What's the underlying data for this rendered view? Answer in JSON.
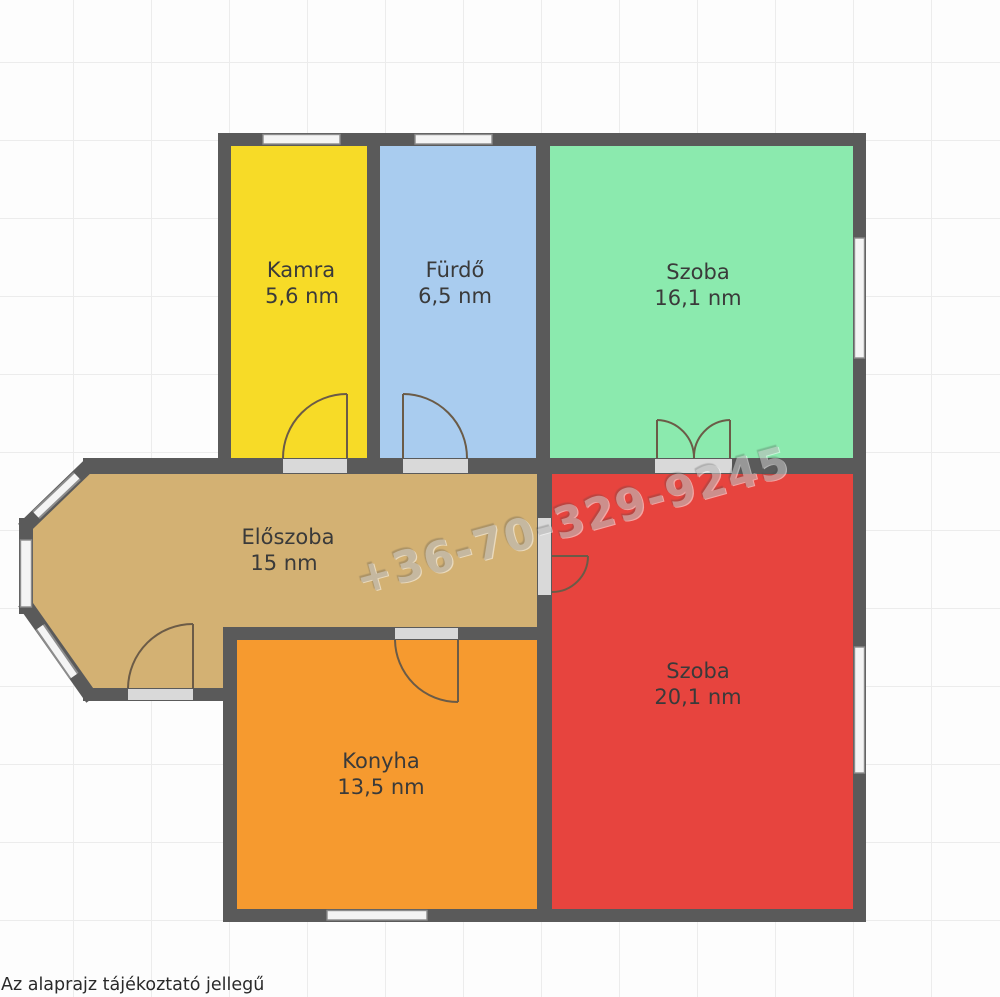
{
  "plan": {
    "rooms": [
      {
        "id": "kamra",
        "name": "Kamra",
        "area": "5,6 nm",
        "color": "#F7DB27"
      },
      {
        "id": "furdo",
        "name": "Fürdő",
        "area": "6,5 nm",
        "color": "#A9CCEF"
      },
      {
        "id": "szoba-1",
        "name": "Szoba",
        "area": "16,1 nm",
        "color": "#8BEAAE"
      },
      {
        "id": "eloszoba",
        "name": "Előszoba",
        "area": "15 nm",
        "color": "#D3B173"
      },
      {
        "id": "szoba-2",
        "name": "Szoba",
        "area": "20,1 nm",
        "color": "#E7443E"
      },
      {
        "id": "konyha",
        "name": "Konyha",
        "area": "13,5 nm",
        "color": "#F69A2F"
      }
    ]
  },
  "watermark": {
    "text": "+36-70-329-9245"
  },
  "footer": {
    "disclaimer": "Az alaprajz tájékoztató jellegű"
  },
  "palette": {
    "bg": "#fdfdfd",
    "grid": "#ececec",
    "wall": "#5a5a5a",
    "opening": "#d9d9d9",
    "window_fill": "#f4f4f4",
    "window_frame": "#8c8c8c",
    "door_line": "#6b5b47",
    "label": "#3a3a3a",
    "watermark": "#bdbdbd",
    "text_dark": "#2a2a2a"
  }
}
